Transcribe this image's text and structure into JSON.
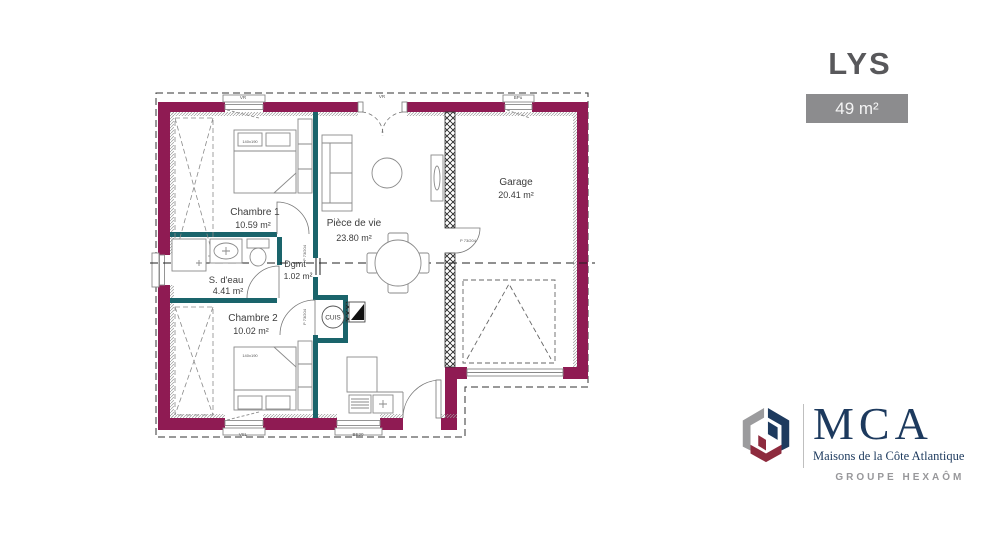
{
  "header": {
    "title": "LYS",
    "area_badge": "49 m²"
  },
  "plan": {
    "rooms": [
      {
        "id": "chambre1",
        "name": "Chambre 1",
        "area": "10.59 m²"
      },
      {
        "id": "piece_de_vie",
        "name": "Pièce de vie",
        "area": "23.80 m²"
      },
      {
        "id": "garage",
        "name": "Garage",
        "area": "20.41 m²"
      },
      {
        "id": "sdeau",
        "name": "S. d'eau",
        "area": "4.41 m²"
      },
      {
        "id": "dgmt",
        "name": "Dgmt",
        "area": "1.02 m²"
      },
      {
        "id": "chambre2",
        "name": "Chambre 2",
        "area": "10.02 m²"
      }
    ],
    "kitchen_label": "CUIS",
    "door_tag": "P 73/204",
    "bed_tag": "140x190",
    "window_tags": {
      "top_left": "VR",
      "top_center": "VR",
      "top_right": "BPu",
      "bottom_left": "VSL",
      "bottom_center": "BE20"
    }
  },
  "brand": {
    "initials": "MCA",
    "tagline": "Maisons de la Côte Atlantique",
    "group": "GROUPE HEXAÔM"
  },
  "colors": {
    "exterior_wall": "#8f1b53",
    "partition_wall": "#1a646b",
    "badge_bg": "#8c8c8e",
    "title_gray": "#58585b",
    "brand_navy": "#1d3a5e",
    "brand_red": "#8e2b3e",
    "brand_gray": "#9b9b9d"
  }
}
